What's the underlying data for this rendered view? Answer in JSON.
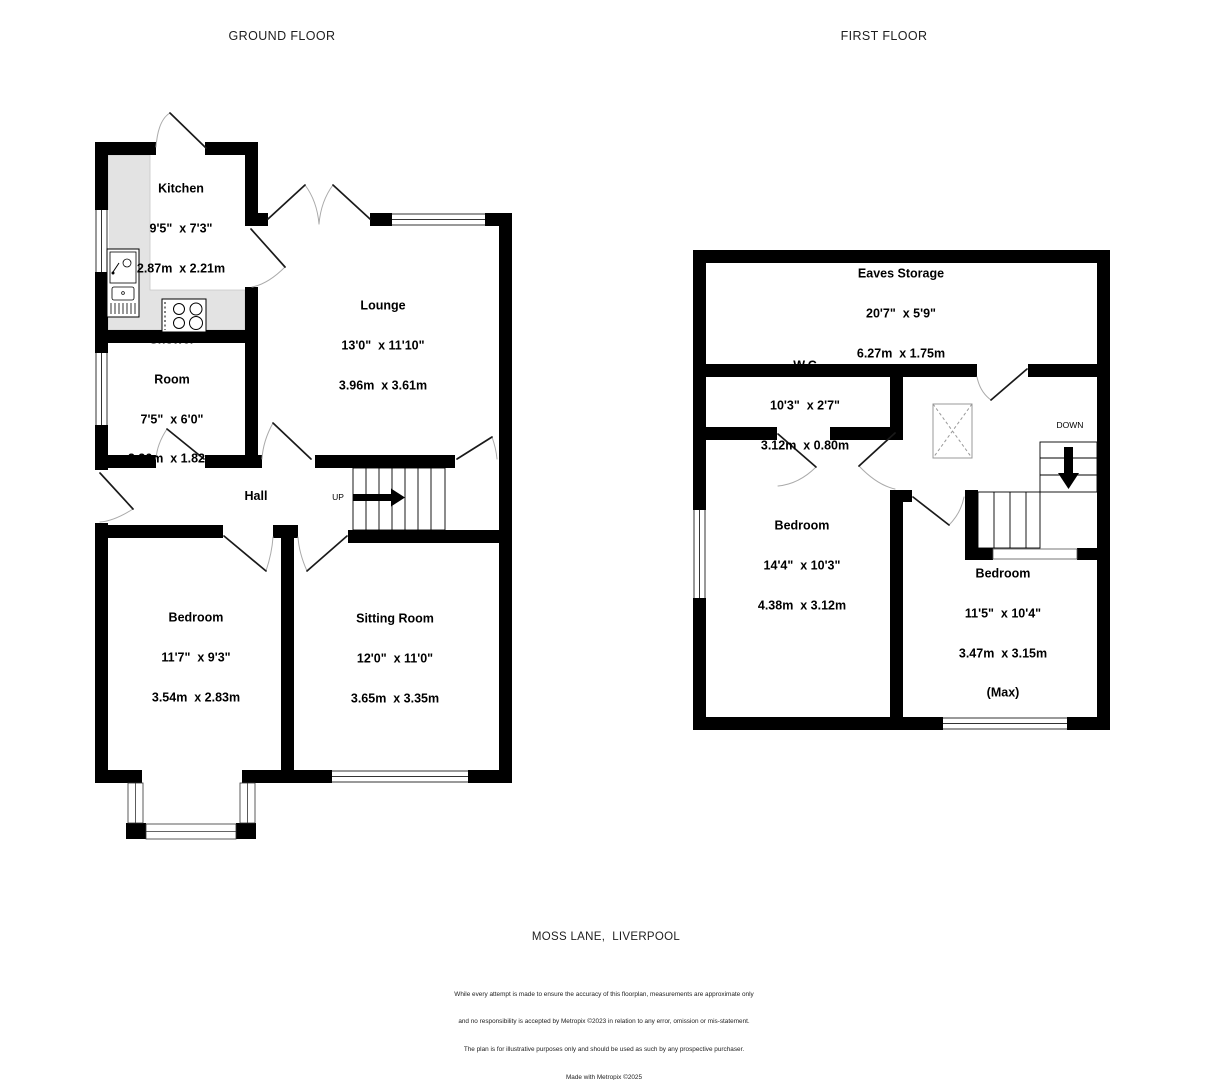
{
  "titles": {
    "ground": "GROUND FLOOR",
    "first": "FIRST FLOOR"
  },
  "address": "MOSS LANE,  LIVERPOOL",
  "disclaimer": [
    "While every attempt is made to ensure the accuracy of this floorplan, measurements are approximate only",
    "and no responsibility is accepted by Metropix ©2023 in relation to any error, omission or mis-statement.",
    "The plan is for illustrative purposes only and should be used as such by any prospective purchaser.",
    "Made with Metropix ©2025"
  ],
  "stairs": {
    "up": "UP",
    "down": "DOWN"
  },
  "ground_floor": {
    "kitchen": {
      "name": "Kitchen",
      "imperial": "9'5\"  x 7'3\"",
      "metric": "2.87m  x 2.21m"
    },
    "lounge": {
      "name": "Lounge",
      "imperial": "13'0\"  x 11'10\"",
      "metric": "3.96m  x 3.61m"
    },
    "shower_room": {
      "name1": "Shower",
      "name2": "Room",
      "imperial": "7'5\"  x 6'0\"",
      "metric": "2.26m  x 1.82m"
    },
    "hall": {
      "name": "Hall"
    },
    "bedroom": {
      "name": "Bedroom",
      "imperial": "11'7\"  x 9'3\"",
      "metric": "3.54m  x 2.83m"
    },
    "sitting_room": {
      "name": "Sitting Room",
      "imperial": "12'0\"  x 11'0\"",
      "metric": "3.65m  x 3.35m"
    }
  },
  "first_floor": {
    "eaves_storage": {
      "name": "Eaves Storage",
      "imperial": "20'7\"  x 5'9\"",
      "metric": "6.27m  x 1.75m"
    },
    "wc": {
      "name": "W.C",
      "imperial": "10'3\"  x 2'7\"",
      "metric": "3.12m  x 0.80m"
    },
    "bedroom_1": {
      "name": "Bedroom",
      "imperial": "14'4\"  x 10'3\"",
      "metric": "4.38m  x 3.12m"
    },
    "bedroom_2": {
      "name": "Bedroom",
      "imperial": "11'5\"  x 10'4\"",
      "metric": "3.47m  x 3.15m",
      "note": "(Max)"
    }
  }
}
